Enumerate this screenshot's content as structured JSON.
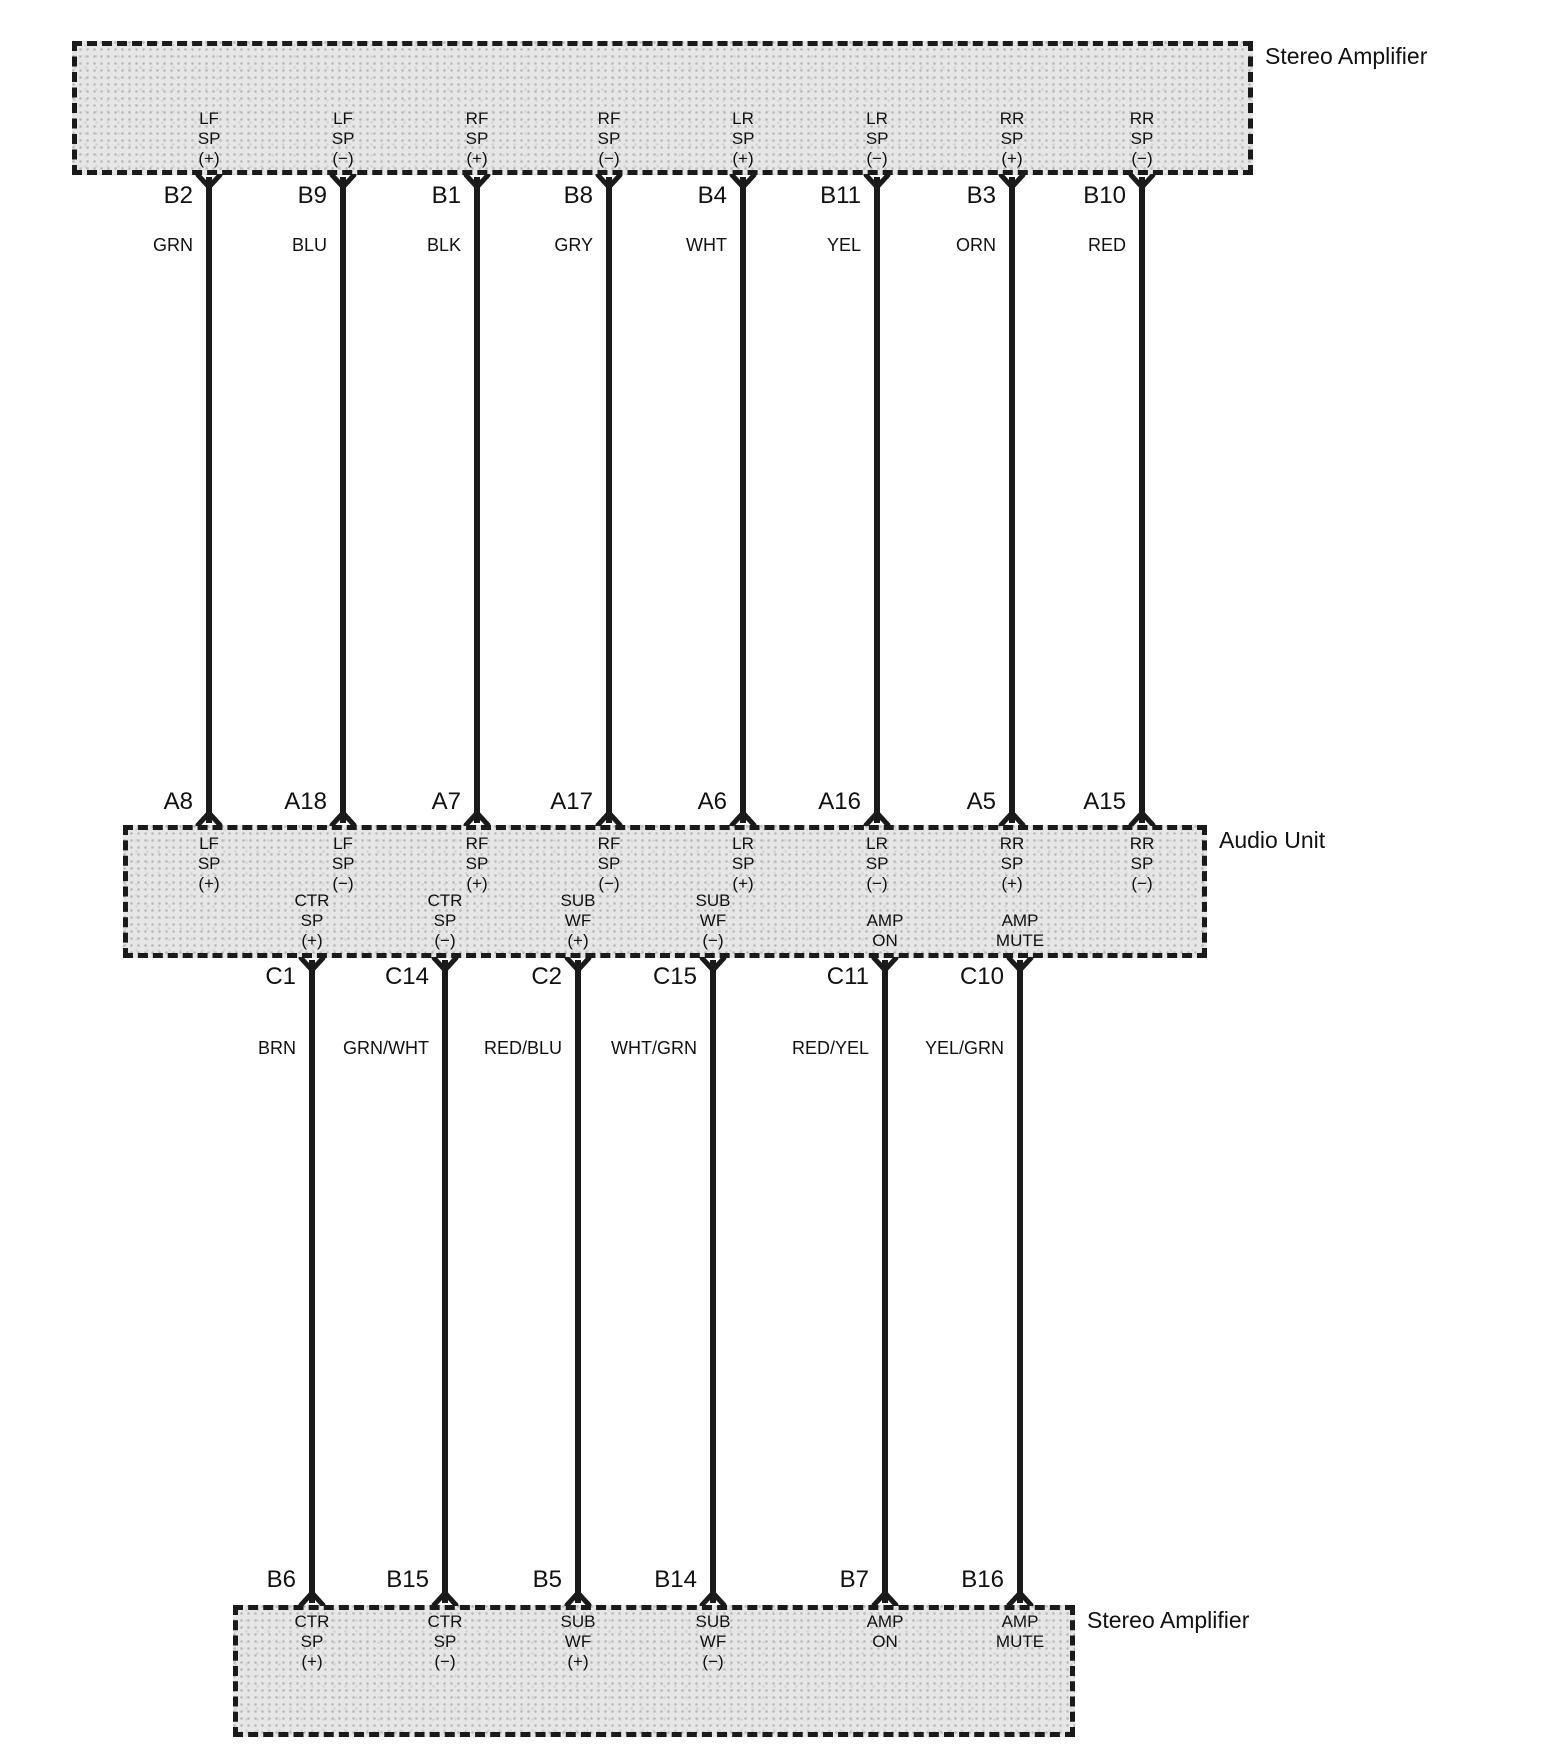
{
  "diagram": {
    "canvas": {
      "width": 1543,
      "height": 1760,
      "background": "#ffffff",
      "line_color": "#1a1a1a",
      "box_fill": "#e6e6e6"
    },
    "top_amplifier": {
      "title": "Stereo Amplifier",
      "box": {
        "left": 72,
        "top": 41,
        "width": 1181,
        "height": 134
      }
    },
    "audio_unit": {
      "title": "Audio Unit",
      "box": {
        "left": 123,
        "top": 825,
        "width": 1084,
        "height": 133
      }
    },
    "bottom_amplifier": {
      "title": "Stereo Amplifier",
      "box": {
        "left": 233,
        "top": 1605,
        "width": 842,
        "height": 132
      }
    },
    "speaker_wires": [
      {
        "x": 209,
        "amp_pin": "B2",
        "amp_function": "LF\nSP (+)",
        "wire_color": "GRN",
        "audio_pin": "A8",
        "audio_function": "LF\nSP (+)"
      },
      {
        "x": 343,
        "amp_pin": "B9",
        "amp_function": "LF\nSP (−)",
        "wire_color": "BLU",
        "audio_pin": "A18",
        "audio_function": "LF\nSP (−)"
      },
      {
        "x": 477,
        "amp_pin": "B1",
        "amp_function": "RF\nSP (+)",
        "wire_color": "BLK",
        "audio_pin": "A7",
        "audio_function": "RF\nSP (+)"
      },
      {
        "x": 609,
        "amp_pin": "B8",
        "amp_function": "RF\nSP (−)",
        "wire_color": "GRY",
        "audio_pin": "A17",
        "audio_function": "RF\nSP (−)"
      },
      {
        "x": 743,
        "amp_pin": "B4",
        "amp_function": "LR\nSP (+)",
        "wire_color": "WHT",
        "audio_pin": "A6",
        "audio_function": "LR\nSP (+)"
      },
      {
        "x": 877,
        "amp_pin": "B11",
        "amp_function": "LR\nSP (−)",
        "wire_color": "YEL",
        "audio_pin": "A16",
        "audio_function": "LR\nSP (−)"
      },
      {
        "x": 1012,
        "amp_pin": "B3",
        "amp_function": "RR\nSP (+)",
        "wire_color": "ORN",
        "audio_pin": "A5",
        "audio_function": "RR\nSP (+)"
      },
      {
        "x": 1142,
        "amp_pin": "B10",
        "amp_function": "RR\nSP (−)",
        "wire_color": "RED",
        "audio_pin": "A15",
        "audio_function": "RR\nSP (−)"
      }
    ],
    "amp_control_wires": [
      {
        "x": 312,
        "audio_pin": "C1",
        "audio_function": "CTR\nSP (+)",
        "wire_color": "BRN",
        "amp_pin": "B6",
        "amp_function": "CTR\nSP (+)"
      },
      {
        "x": 445,
        "audio_pin": "C14",
        "audio_function": "CTR\nSP (−)",
        "wire_color": "GRN/WHT",
        "amp_pin": "B15",
        "amp_function": "CTR\nSP (−)"
      },
      {
        "x": 578,
        "audio_pin": "C2",
        "audio_function": "SUB\nWF (+)",
        "wire_color": "RED/BLU",
        "amp_pin": "B5",
        "amp_function": "SUB\nWF (+)"
      },
      {
        "x": 713,
        "audio_pin": "C15",
        "audio_function": "SUB\nWF (−)",
        "wire_color": "WHT/GRN",
        "amp_pin": "B14",
        "amp_function": "SUB\nWF (−)"
      },
      {
        "x": 885,
        "audio_pin": "C11",
        "audio_function": "AMP\nON",
        "wire_color": "RED/YEL",
        "amp_pin": "B7",
        "amp_function": "AMP\nON"
      },
      {
        "x": 1020,
        "audio_pin": "C10",
        "audio_function": "AMP\nMUTE",
        "wire_color": "YEL/GRN",
        "amp_pin": "B16",
        "amp_function": "AMP\nMUTE"
      }
    ]
  }
}
